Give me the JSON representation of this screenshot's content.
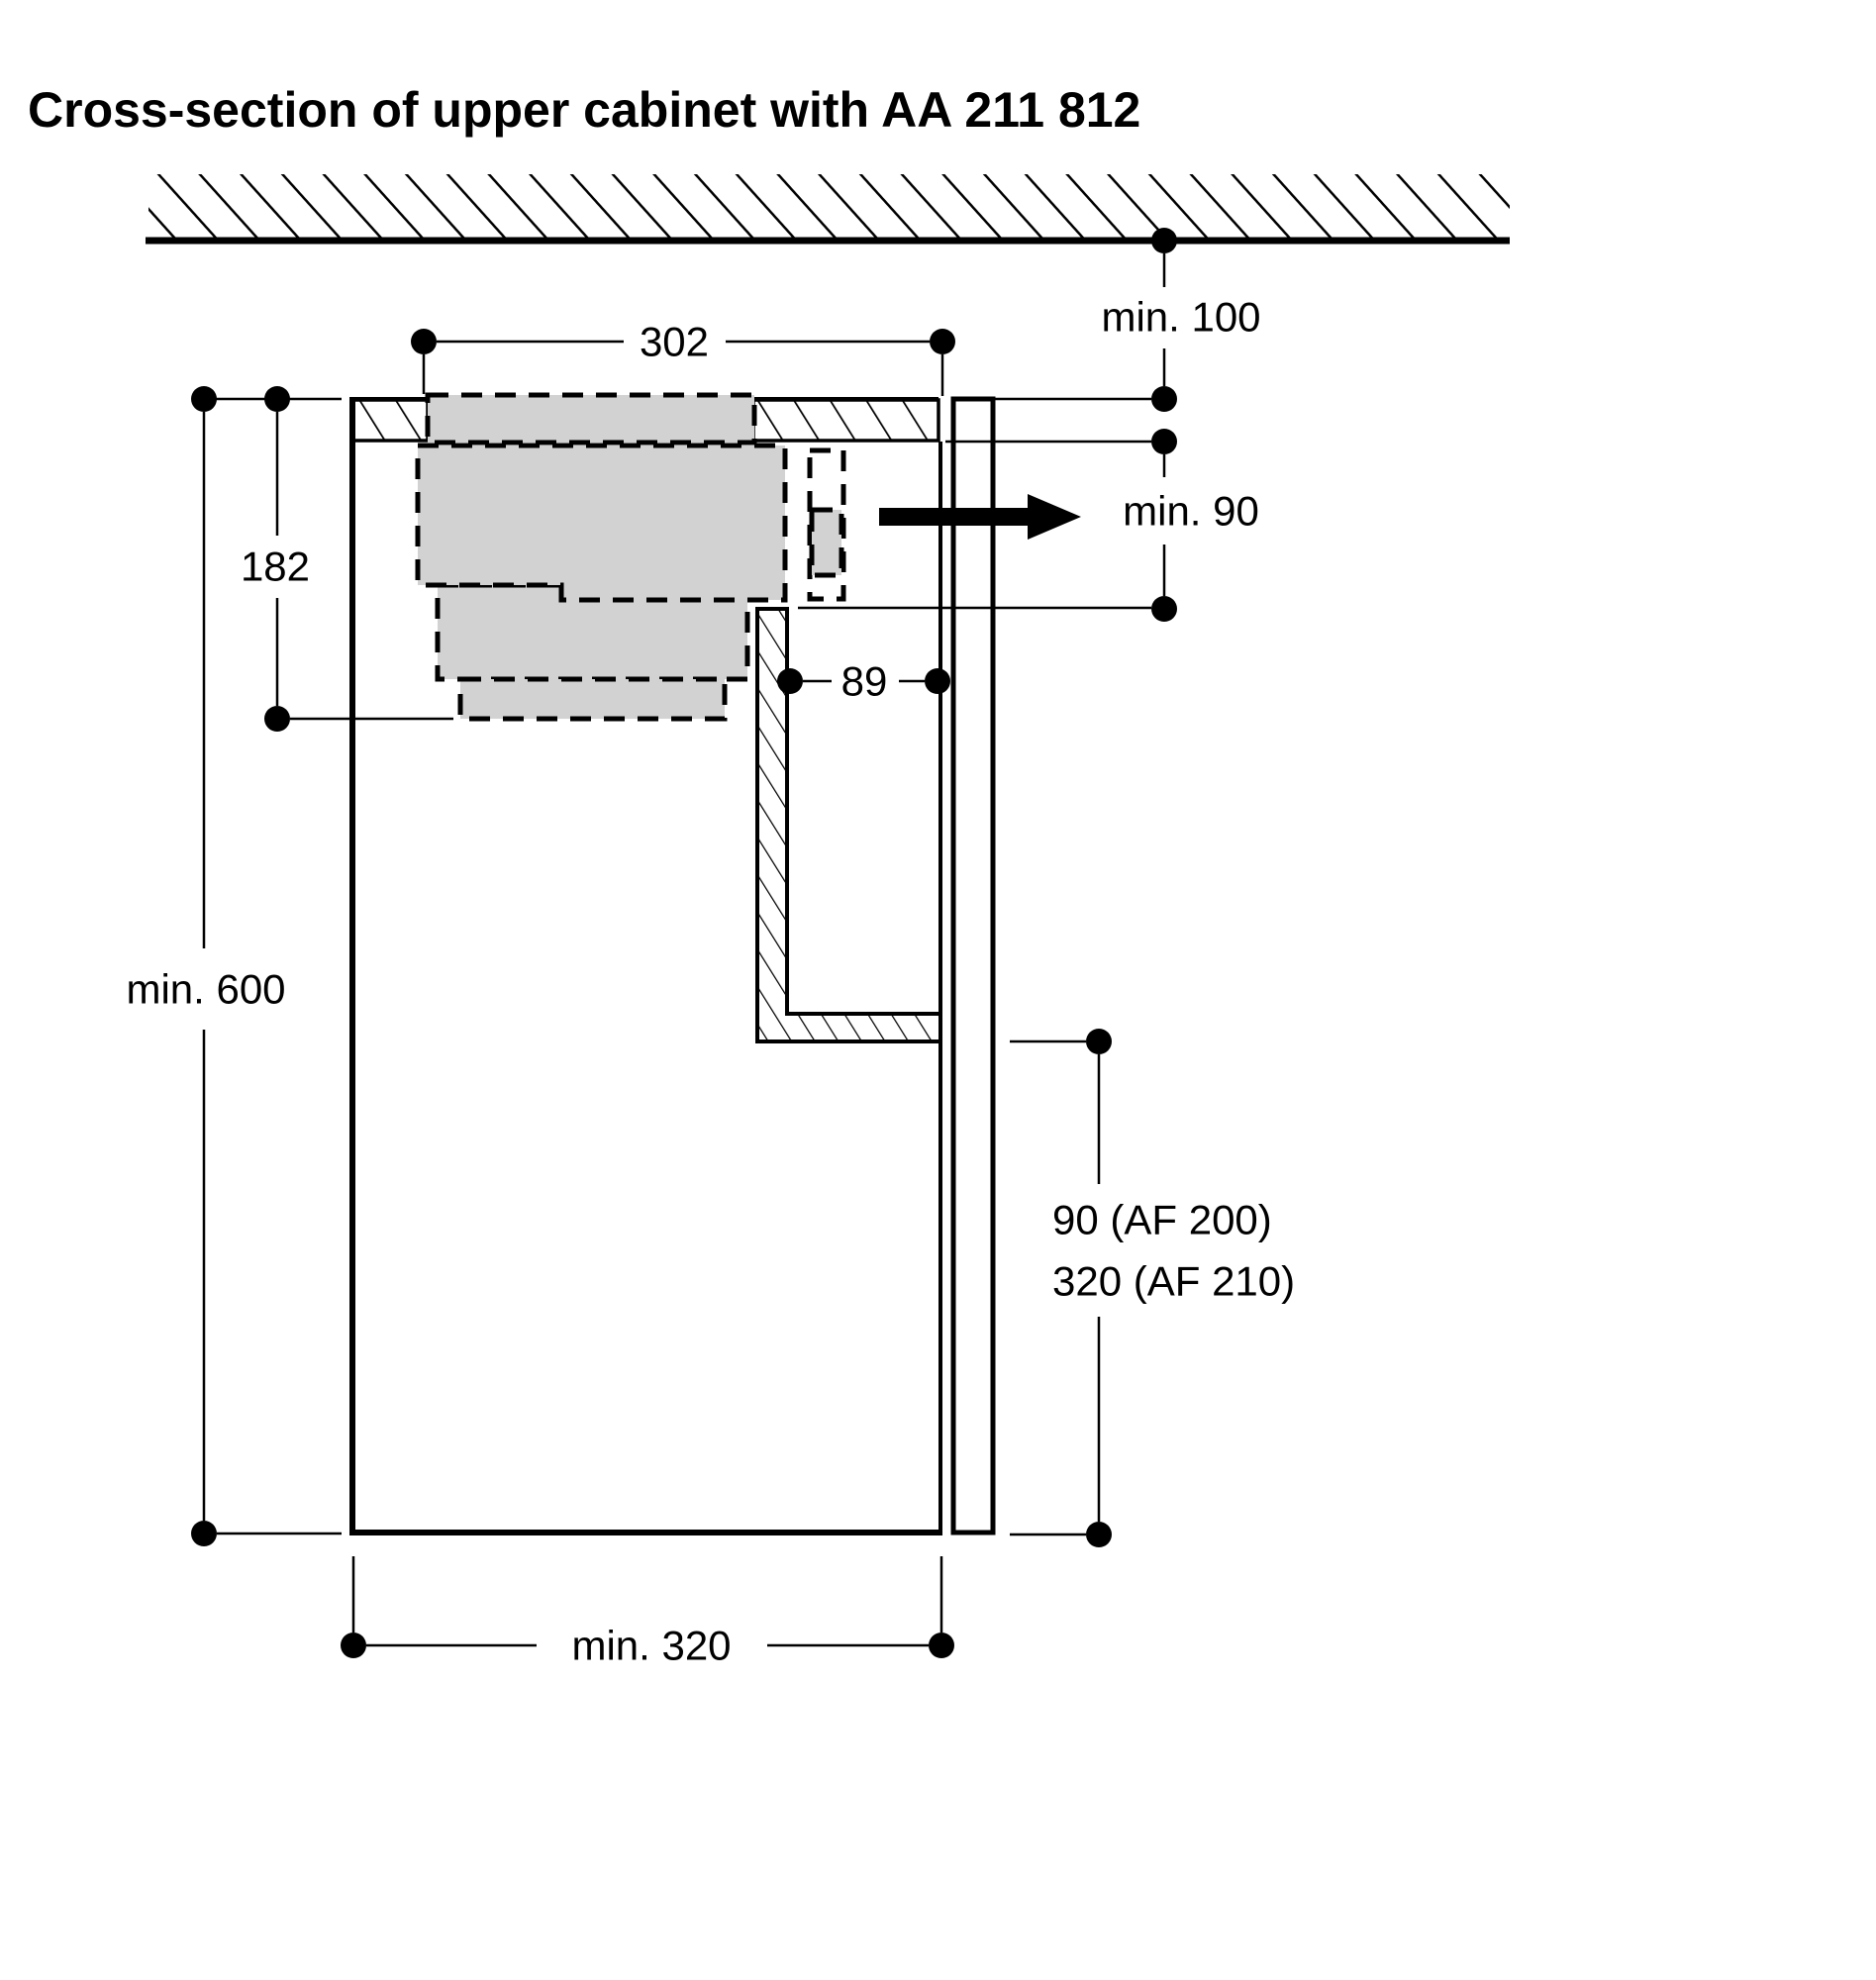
{
  "title": "Cross-section of upper cabinet with AA 211 812",
  "dims": {
    "top_width": "302",
    "gap_ceiling": "min. 100",
    "gap_rear": "min. 90",
    "appliance_height": "182",
    "duct_to_wall": "89",
    "cabinet_height": "min. 600",
    "cabinet_depth": "min. 320",
    "vent_line1": "90 (AF 200)",
    "vent_line2": "320 (AF 210)"
  },
  "colors": {
    "ink": "#000000",
    "appliance_fill": "#d2d2d2",
    "background": "#ffffff"
  }
}
